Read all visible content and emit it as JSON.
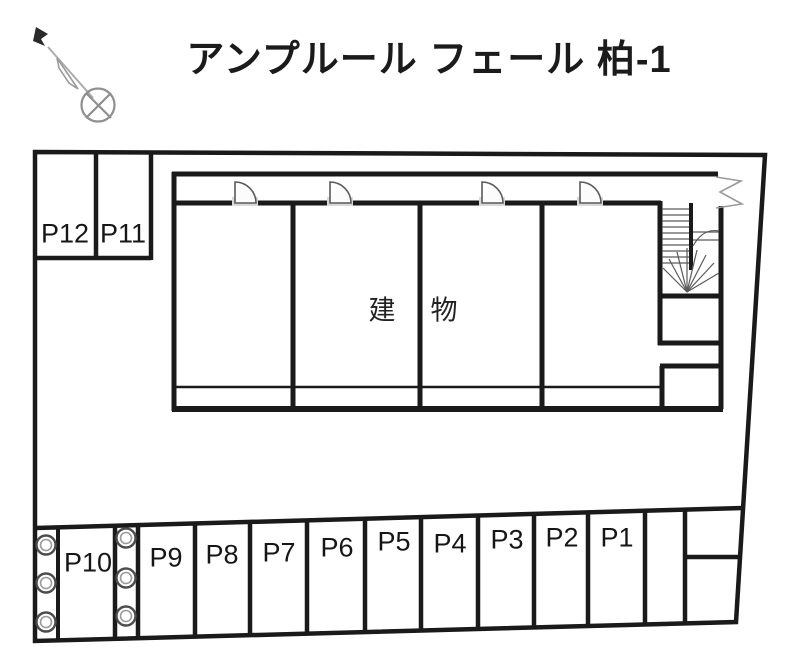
{
  "title": "アンプルール フェール 柏-1",
  "building": {
    "label": "建　物"
  },
  "parking": {
    "stalls": [
      {
        "id": "P1",
        "label": "P1"
      },
      {
        "id": "P2",
        "label": "P2"
      },
      {
        "id": "P3",
        "label": "P3"
      },
      {
        "id": "P4",
        "label": "P4"
      },
      {
        "id": "P5",
        "label": "P5"
      },
      {
        "id": "P6",
        "label": "P6"
      },
      {
        "id": "P7",
        "label": "P7"
      },
      {
        "id": "P8",
        "label": "P8"
      },
      {
        "id": "P9",
        "label": "P9"
      },
      {
        "id": "P10",
        "label": "P10"
      },
      {
        "id": "P11",
        "label": "P11"
      },
      {
        "id": "P12",
        "label": "P12"
      }
    ]
  },
  "icons": {
    "compass": "north-compass-icon",
    "stairs": "staircase-icon",
    "door": "door-swing-icon",
    "bush": "shrub-icon",
    "break_mark": "boundary-break-icon"
  },
  "colors": {
    "line": "#1a1a1a",
    "thin_line": "#555555",
    "gray_symbol": "#979797",
    "door_threshold": "#d9d9d9"
  }
}
